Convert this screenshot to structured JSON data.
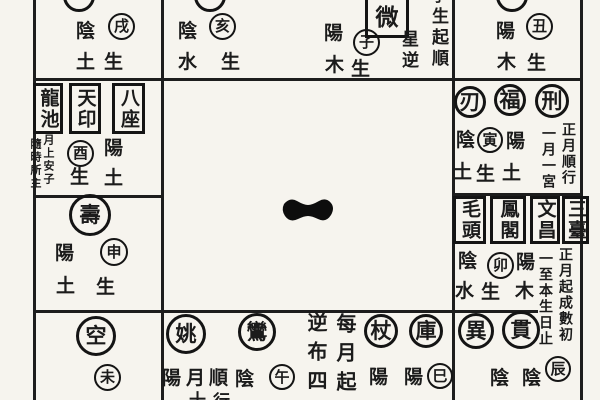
{
  "colors": {
    "paper": "#f6f4ee",
    "ink": "#1b1b1b"
  },
  "chart": {
    "top": {
      "xu": {
        "pol": "陰",
        "el": "土",
        "br": "戌",
        "sh": "生"
      },
      "hai": {
        "pol": "陰",
        "el": "水",
        "br": "亥",
        "sh": "生"
      },
      "zi": {
        "pol": "陽",
        "el": "木",
        "br": "子",
        "sh": "生",
        "box": "微",
        "col_inner": "星逆",
        "col_outer": "生起順",
        "col_outer_partial": "子"
      },
      "chou": {
        "pol": "陽",
        "el": "木",
        "br": "丑",
        "sh": "生"
      }
    },
    "left": {
      "boxes": [
        "龍池",
        "天印",
        "八座"
      ],
      "note_right": "月上安子",
      "note_left": "隨時所主",
      "you": {
        "br": "酉",
        "pol": "陽",
        "el": "土",
        "sh": "生"
      },
      "shou": {
        "star": "壽",
        "pol": "陽",
        "br": "申",
        "el": "土",
        "sh": "生"
      },
      "kong": {
        "star": "空",
        "br": "未"
      }
    },
    "right": {
      "r2": {
        "stars": [
          "刃",
          "福",
          "刑"
        ],
        "pol_l": "陰",
        "br": "寅",
        "pol_r": "陽",
        "el_l": "土",
        "sh": "生",
        "el_r": "土",
        "note_outer": "正月順行",
        "note_inner": "一月一宮"
      },
      "r3": {
        "boxes": [
          "毛頭",
          "鳳閣",
          "文昌",
          "三臺"
        ],
        "pol_l": "陰",
        "br": "卯",
        "pol_r": "陽",
        "el_l": "水",
        "sh": "生",
        "el_r": "木",
        "note_outer": "正月起成數初",
        "note_inner": "一至本生日止"
      },
      "r4": {
        "stars": [
          "異",
          "貫"
        ],
        "pol_1": "陰",
        "pol_2": "陰",
        "br": "辰"
      }
    },
    "bottom": {
      "stars": [
        "姚",
        "鸞"
      ],
      "chars": [
        "陽",
        "月",
        "順",
        "陰"
      ],
      "wu": "午",
      "col_a": "逆布四",
      "col_b": "每月起",
      "stars2": [
        "杖",
        "庫"
      ],
      "pol_1": "陽",
      "pol_2": "陽",
      "si": "巳",
      "fragments": [
        "十",
        "行"
      ]
    }
  }
}
